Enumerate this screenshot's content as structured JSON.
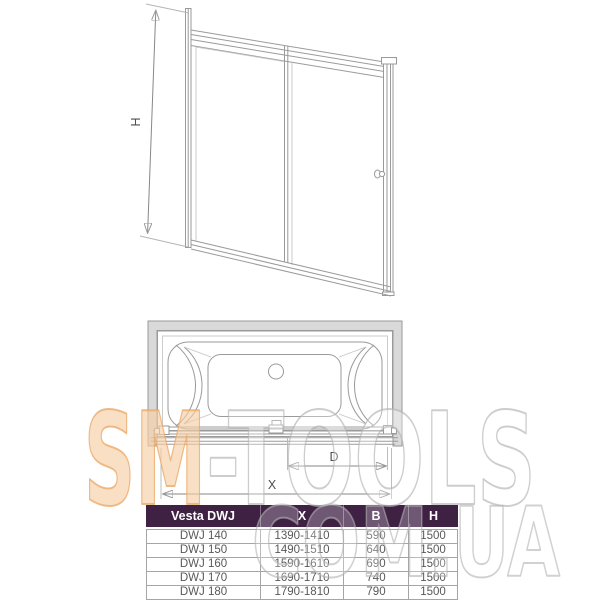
{
  "drawing": {
    "door_front_view": {
      "height_dim_label": "H"
    },
    "tub_top_view": {
      "door_width_dim_label": "D",
      "total_width_dim_label": "X"
    }
  },
  "table": {
    "columns": [
      "Vesta DWJ",
      "X",
      "B",
      "H"
    ],
    "rows": [
      [
        "DWJ 140",
        "1390-1410",
        "590",
        "1500"
      ],
      [
        "DWJ 150",
        "1490-1510",
        "640",
        "1500"
      ],
      [
        "DWJ 160",
        "1590-1610",
        "690",
        "1500"
      ],
      [
        "DWJ 170",
        "1690-1710",
        "740",
        "1500"
      ],
      [
        "DWJ 180",
        "1790-1810",
        "790",
        "1500"
      ]
    ],
    "header_bg": "#3f2144",
    "header_text_color": "#ffffff"
  },
  "watermark": {
    "brand_primary": "SM",
    "brand_secondary": "-TOOLS",
    "domain": "COM.UA",
    "accent_color": "#f0b27d"
  }
}
